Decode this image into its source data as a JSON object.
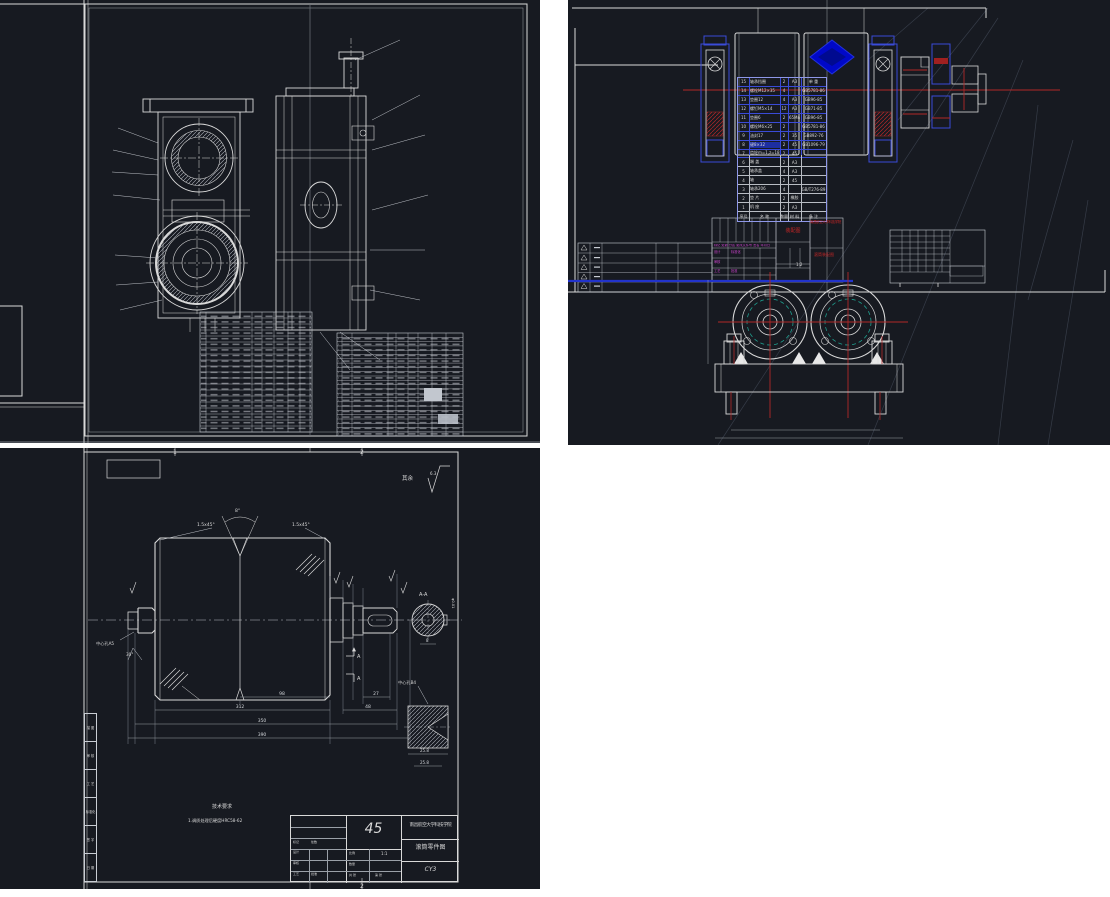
{
  "colors": {
    "canvas_bg": "#171a21",
    "page_bg": "#ffffff",
    "line_white": "#d9d9d9",
    "accent_red": "#b02828",
    "selection_blue": "#2233cc",
    "accent_magenta": "#cc44cc",
    "accent_teal": "#1f9e8e"
  },
  "assembly_bom": {
    "header": {
      "no": "序号",
      "name": "名 称",
      "qty": "数量",
      "mat": "材 料",
      "note": "备 注"
    },
    "rows": [
      {
        "no": "15",
        "name": "轴承挡圈",
        "qty": "2",
        "mat": "A3",
        "note": "单 重"
      },
      {
        "no": "14",
        "name": "螺栓M12×35",
        "qty": "4",
        "mat": "",
        "note": "GB5781-86"
      },
      {
        "no": "13",
        "name": "垫圈12",
        "qty": "4",
        "mat": "A3",
        "note": "GB96-85"
      },
      {
        "no": "12",
        "name": "螺钉M5×14",
        "qty": "12",
        "mat": "A3",
        "note": "GB71-85"
      },
      {
        "no": "11",
        "name": "垫圈6",
        "qty": "2",
        "mat": "65Mn",
        "note": "GB96-85"
      },
      {
        "no": "10",
        "name": "螺栓M6×25",
        "qty": "2",
        "mat": "",
        "note": "GB5781-86"
      },
      {
        "no": "9",
        "name": "油封17",
        "qty": "2",
        "mat": "35",
        "note": "GB892-76"
      },
      {
        "no": "8",
        "name": "键8×32",
        "qty": "2",
        "mat": "45",
        "note": "GB1096-79"
      },
      {
        "no": "7",
        "name": "齿轮m=1,z=18",
        "qty": "2",
        "mat": "45",
        "note": ""
      },
      {
        "no": "6",
        "name": "端 盖",
        "qty": "2",
        "mat": "A3",
        "note": ""
      },
      {
        "no": "5",
        "name": "轴承盖",
        "qty": "4",
        "mat": "A3",
        "note": ""
      },
      {
        "no": "4",
        "name": "轴",
        "qty": "2",
        "mat": "45",
        "note": ""
      },
      {
        "no": "3",
        "name": "轴承206",
        "qty": "4",
        "mat": "",
        "note": "GB/T276-89"
      },
      {
        "no": "2",
        "name": "垫 片",
        "qty": "2",
        "mat": "橡胶",
        "note": ""
      },
      {
        "no": "1",
        "name": "机 座",
        "qty": "2",
        "mat": "A3",
        "note": ""
      }
    ]
  },
  "assembly_title_block": {
    "doc_label": "装配图",
    "school": "南昌航空大学科技学院",
    "drawing_title": "滚筒装配图",
    "rev_header": "标记 处数 分区 更改文件号 签名 年月日",
    "sig_design": "设计",
    "sig_check": "审核",
    "sig_standard": "标准化",
    "sig_craft": "工艺",
    "sig_approve": "批准",
    "scale": "1:2"
  },
  "part_drawing": {
    "zone_top_1": "1",
    "zone_top_2": "2",
    "zone_bottom_2": "2",
    "rest_label": "其余",
    "rest_roughness": "6.3",
    "chamfer_left": "1.5x45°",
    "chamfer_right": "1.5x45°",
    "groove_angle": "8°",
    "section_label": "A-A",
    "section_arrow_a1": "A",
    "section_arrow_a2": "A",
    "tolerance_note": "φ0.01",
    "center_hole_left": "中心孔A5",
    "center_hole_right": "中心孔B4",
    "angle_30": "30°",
    "dims": {
      "d98": "98",
      "d27": "27",
      "d312": "312",
      "d48": "48",
      "d350": "350",
      "d390": "390",
      "d8": "8",
      "d258a": "25.8",
      "d258b": "25.8"
    },
    "notes_title": "技术要求",
    "notes_line1": "1.调质处理后硬度HRC58-62",
    "strip_labels": [
      {
        "t": "描 图"
      },
      {
        "t": "审 核"
      },
      {
        "t": "工 艺"
      },
      {
        "t": "标准化"
      },
      {
        "t": "签 字"
      },
      {
        "t": "日 期"
      }
    ],
    "title_block": {
      "material": "45",
      "school": "南昌航空大学科技学院",
      "drawing_title": "滚筒零件图",
      "drawing_no": "CY3",
      "scale_label": "比例",
      "scale": "1:1",
      "qty_label": "数量",
      "sheet_label": "共 张",
      "sheet_label2": "第 张",
      "sig_design": "设计",
      "sig_check": "审核",
      "sig_craft": "工艺",
      "sig_approve": "批准",
      "mark_label": "标记",
      "count_label": "处数"
    }
  }
}
